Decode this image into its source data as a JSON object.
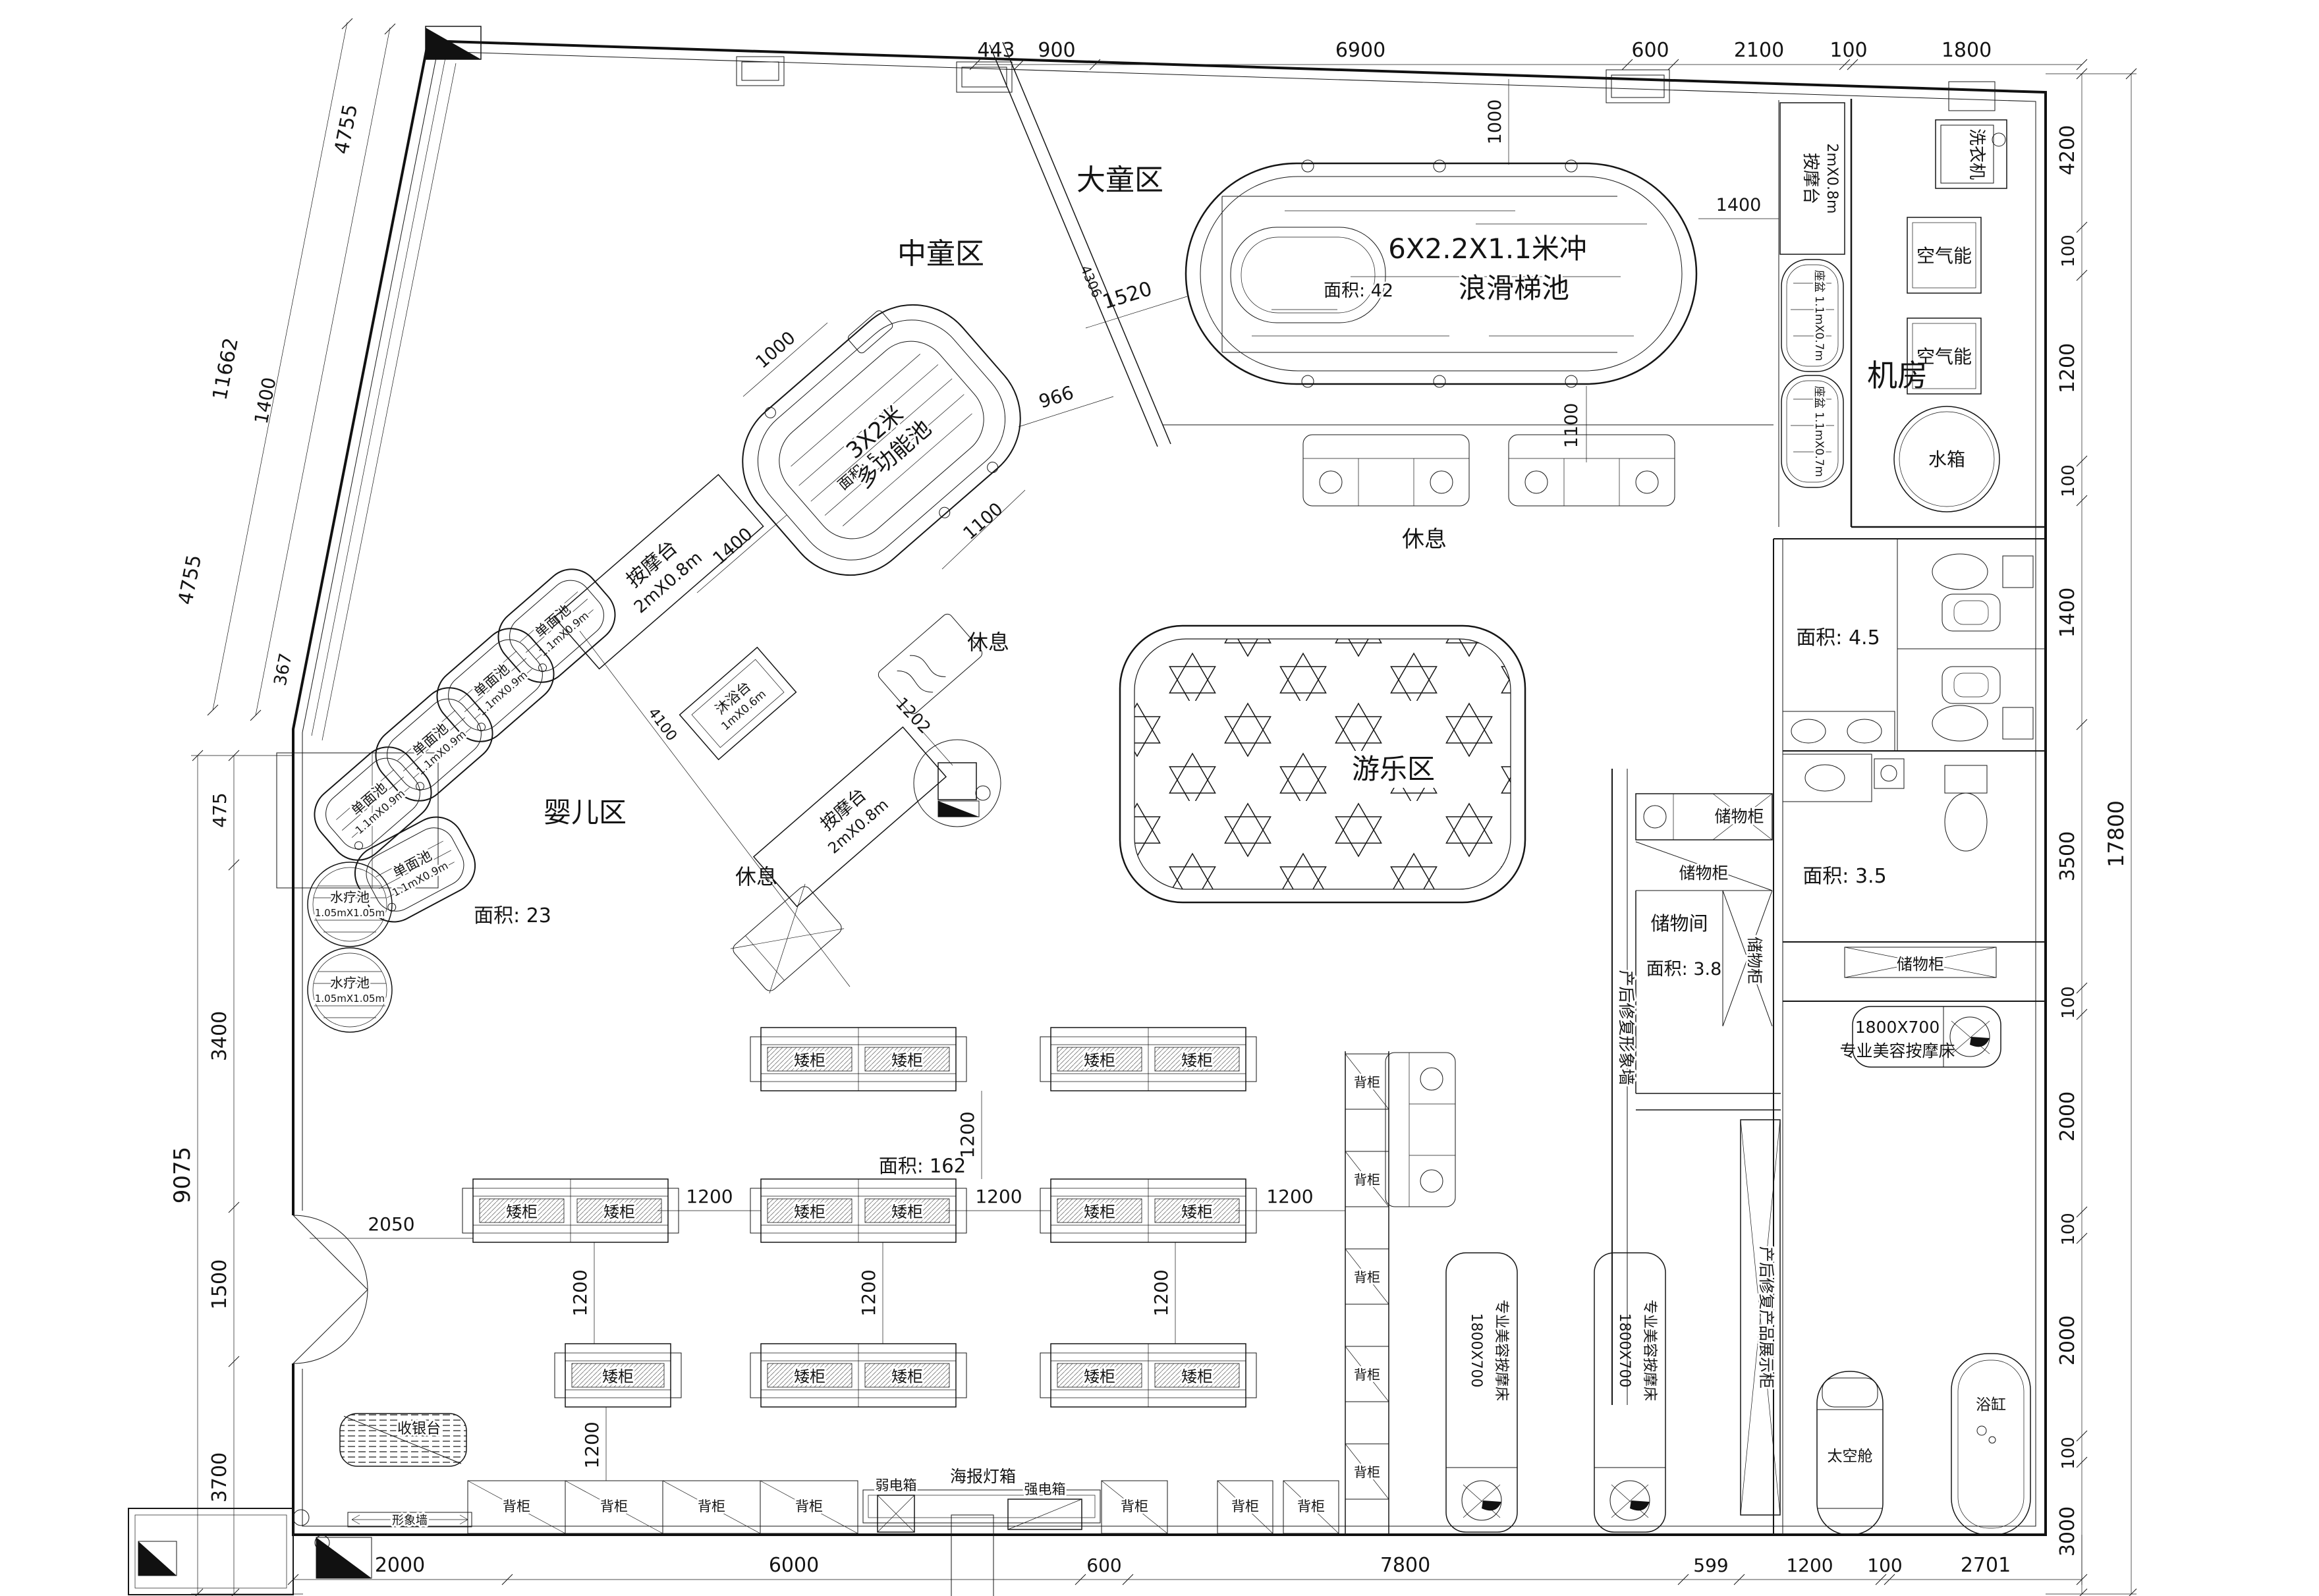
{
  "regions": {
    "big_kids": "大童区",
    "mid_kids": "中童区",
    "infant": "婴儿区",
    "infant_area": "面积: 23",
    "play": "游乐区",
    "machine_room": "机房",
    "rest": "休息",
    "sales_area": "面积: 162"
  },
  "pools": {
    "surf_line1": "6X2.2X1.1米冲",
    "surf_line2": "浪滑梯池",
    "surf_area": "面积: 42",
    "multi_line1": "3X2米",
    "multi_line2": "多功能池",
    "multi_area": "面积: 5",
    "single_line1": "单面池",
    "single_line2": "1.1mX0.9m",
    "spa_line1": "水疗池",
    "spa_line2": "1.05mX1.05m",
    "shower_line1": "沐浴台",
    "shower_line2": "1mX0.6m",
    "massage_line1": "按摩台",
    "massage_line2": "2mX0.8m",
    "basin_label": "座盆 1.1mX0.7m"
  },
  "machine": {
    "washer": "洗衣机",
    "air_energy": "空气能",
    "water_tank": "水箱"
  },
  "bathroom": {
    "area_top": "面积: 4.5",
    "area_bottom": "面积: 3.5"
  },
  "storage": {
    "cabinet": "储物柜",
    "room": "储物间",
    "room_area": "面积: 3.8",
    "pr_wall": "产后修复形象墙",
    "pr_display": "产后修复产品展示柜"
  },
  "furniture": {
    "low_cabinet": "矮柜",
    "back_cabinet": "背柜",
    "cashier": "收银台",
    "image_wall": "形象墙",
    "poster_lightbox": "海报灯箱",
    "weak_box": "弱电箱",
    "strong_box": "强电箱",
    "bed_size": "1800X700",
    "beauty_bed": "专业美容按摩床",
    "capsule": "太空舱",
    "bathtub": "浴缸"
  },
  "dims": {
    "top": [
      "443",
      "900",
      "6900",
      "600",
      "2100",
      "100",
      "1800"
    ],
    "right": [
      "4200",
      "100",
      "1200",
      "100",
      "1400",
      "3500",
      "100",
      "2000",
      "100",
      "2000",
      "100",
      "3000"
    ],
    "right_total": "17800",
    "bottom": [
      "2000",
      "6000",
      "600",
      "7800",
      "599",
      "1200",
      "100",
      "2701"
    ],
    "left": [
      "475",
      "3400",
      "1500",
      "3700"
    ],
    "left_total": "9075",
    "diag": [
      "4755",
      "11662",
      "1400",
      "4755",
      "367"
    ],
    "d1000": "1000",
    "d1400": "1400",
    "d1100": "1100",
    "d1520": "1520",
    "d966": "966",
    "d4306": "4306",
    "d4100": "4100",
    "d1202": "1202",
    "d2050": "2050",
    "d1200": "1200"
  }
}
